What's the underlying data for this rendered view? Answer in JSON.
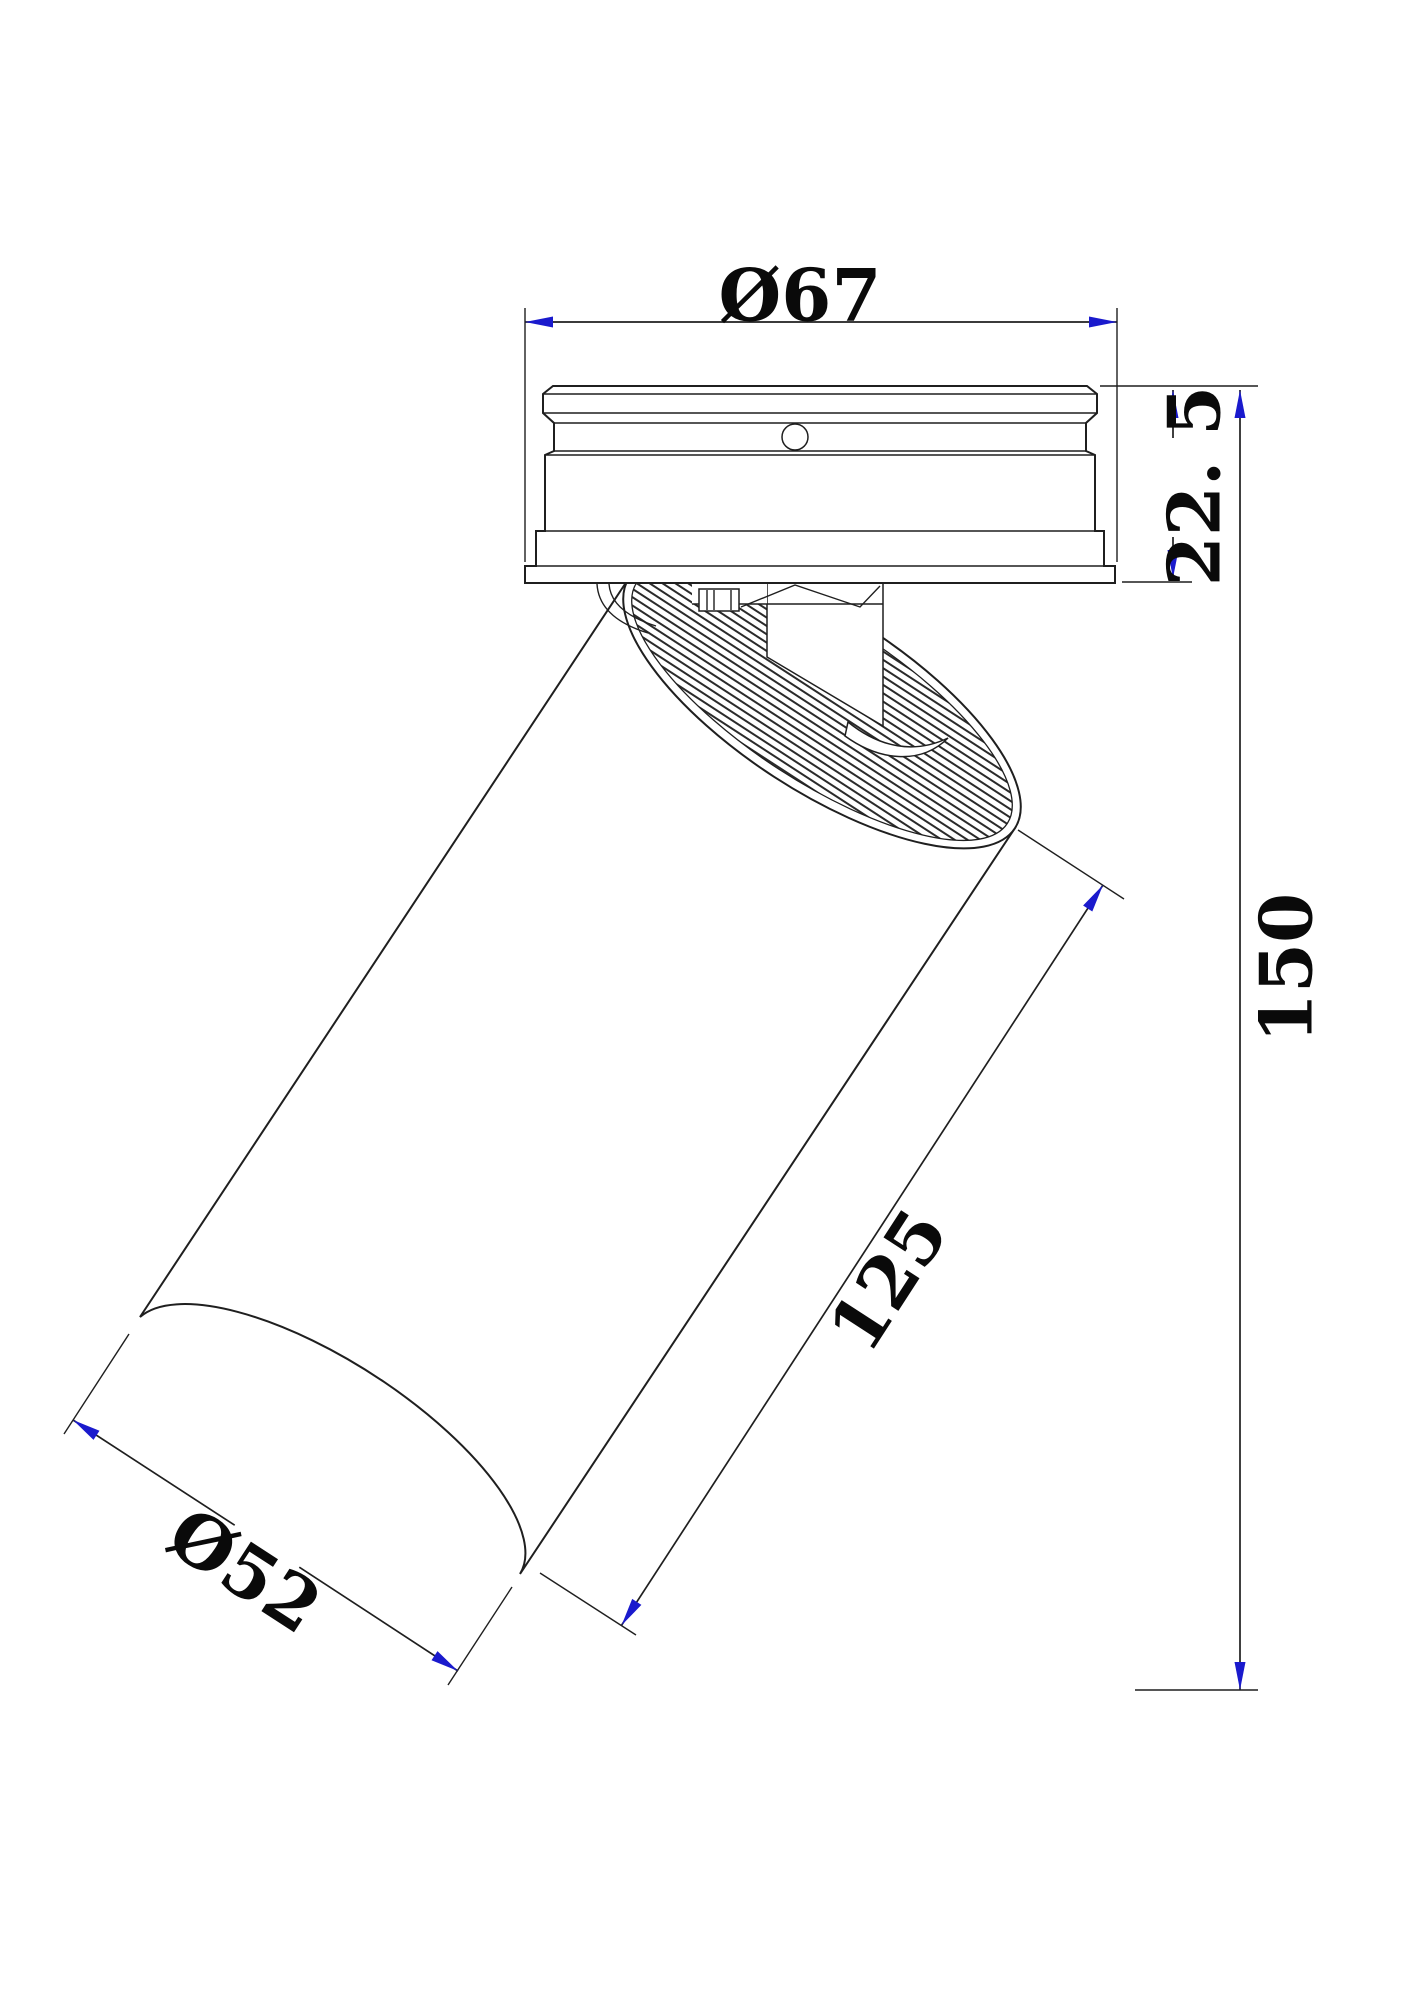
{
  "drawing": {
    "type": "technical-dimension-drawing",
    "subject": "adjustable surface-mounted spot light fixture, side view with tilted cylindrical head",
    "dimensions": {
      "canopy_diameter": "Ø67",
      "canopy_height": "22. 5",
      "overall_height": "150",
      "body_length": "125",
      "body_diameter": "Ø52"
    },
    "colors": {
      "line": "#1f1f1f",
      "arrow": "#1a1acd",
      "text": "#0a0a0a",
      "background": "#ffffff"
    }
  }
}
